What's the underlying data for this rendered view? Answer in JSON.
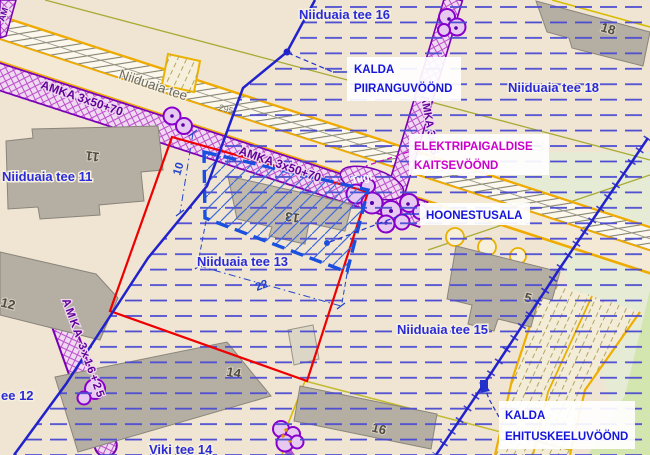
{
  "map": {
    "streets": {
      "niiduaia_tee_16": "Niiduaia tee 16",
      "niiduaia_tee_18": "Niiduaia tee 18",
      "niiduaia_tee_11": "Niiduaia tee 11",
      "niiduaia_tee_13": "Niiduaia tee 13",
      "niiduaia_tee_15": "Niiduaia tee 15",
      "tee_12_partial": "ee 12",
      "viki_tee_14": "Viki tee 14",
      "road_name": "Niiduaia tee",
      "road_number": "295"
    },
    "buildings": {
      "b11": "11",
      "b12": "12",
      "b13": "13",
      "b14": "14",
      "b16": "16",
      "b18": "18",
      "b5": "5"
    },
    "cables": {
      "stub": "AM",
      "main_a": "AMKA 3x50+70",
      "main_b": "AMKA 3x50+70",
      "branch": "AMKA 3x25",
      "pill": "AMKA 3x16+25",
      "pole": "Tugi"
    },
    "dimensions": {
      "width": "10",
      "length": "22"
    },
    "callouts": {
      "piiranguvoond": {
        "line1": "KALDA",
        "line2": "PIIRANGUVÖÖND"
      },
      "elektri": {
        "line1": "ELEKTRIPAIGALDISE",
        "line2": "KAITSEVÖÖND"
      },
      "hoonestusala": {
        "line1": "HOONESTUSALA"
      },
      "ehituskeeluvoond": {
        "line1": "KALDA",
        "line2": "EHITUSKEELUVÖÖND"
      }
    },
    "colors": {
      "plot_boundary_red": "#ee0000",
      "zone_line_blue": "#2222cc",
      "hoonestusala_blue": "#1a50e0",
      "cable_purple": "#8800bb",
      "callout_magenta": "#cc00cc",
      "road_edge_yellow": "#f0ab00",
      "building_gray": "#b5aea2"
    }
  }
}
